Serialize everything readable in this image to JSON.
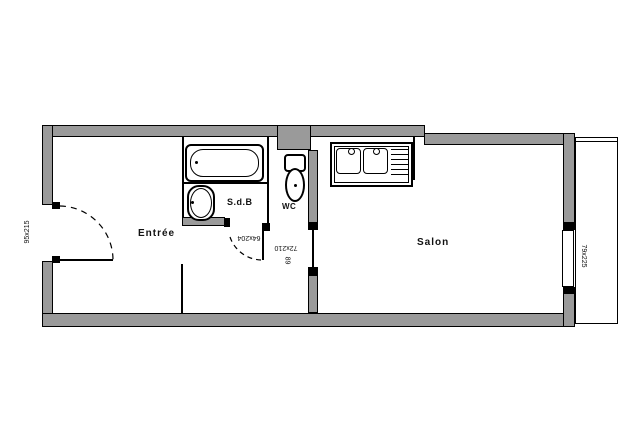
{
  "plan": {
    "title": "studio-floor-plan",
    "rooms": [
      {
        "id": "entree",
        "label": "Entrée"
      },
      {
        "id": "sdb",
        "label": "S.d.B"
      },
      {
        "id": "wc",
        "label": "WC"
      },
      {
        "id": "salon",
        "label": "Salon"
      }
    ],
    "openings": [
      {
        "id": "entrance-door",
        "type": "door",
        "label": "95x215"
      },
      {
        "id": "bathroom-door",
        "type": "door",
        "label": "64x204"
      },
      {
        "id": "salon-door",
        "type": "door",
        "label": "72x210"
      },
      {
        "id": "salon-door-width",
        "type": "door",
        "label": "89"
      },
      {
        "id": "balcony-window",
        "type": "window",
        "label": "79x225"
      }
    ],
    "colors": {
      "wall_fill": "#9a9a9a",
      "line": "#000000",
      "background": "#ffffff"
    }
  }
}
